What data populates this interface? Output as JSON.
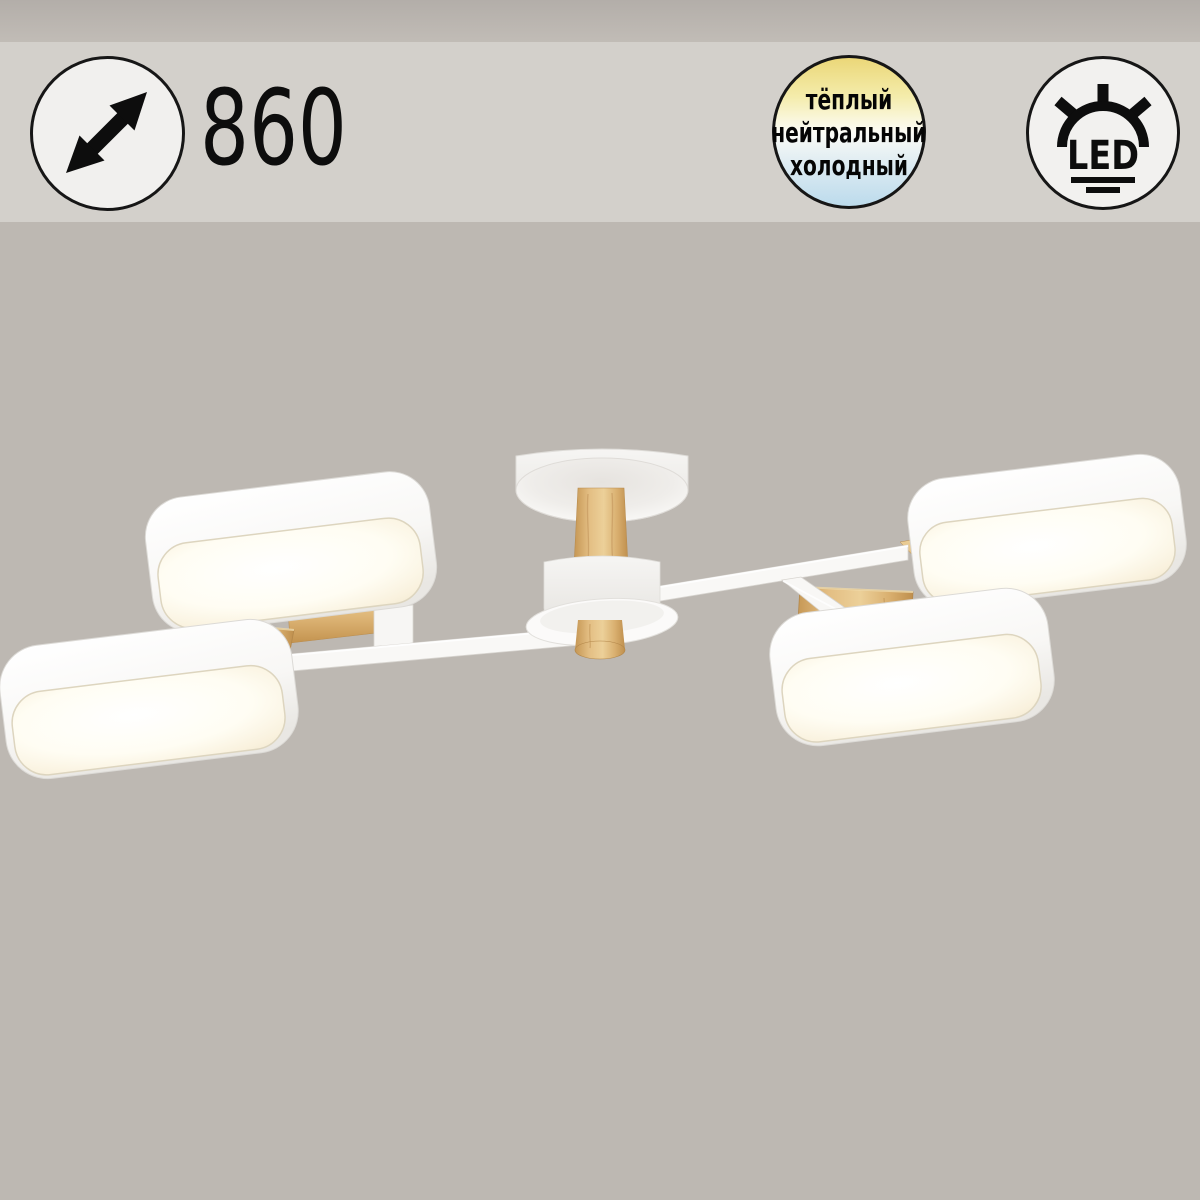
{
  "page": {
    "background_color": "#bdb8b2",
    "header_band_color": "#d3d0cb"
  },
  "badges": {
    "diameter": {
      "value": "860",
      "icon": "diagonal-double-arrow",
      "circle_fill": "#f1f0ee",
      "circle_stroke": "#161616"
    },
    "color_temperature": {
      "circle_stroke": "#161616",
      "options": [
        {
          "label": "тёплый",
          "swatch": "#ebd778"
        },
        {
          "label": "нейтральный",
          "swatch": "#fcfcf6"
        },
        {
          "label": "холодный",
          "swatch": "#bcdbec"
        }
      ]
    },
    "led": {
      "label": "LED",
      "icon": "led-light-rays",
      "circle_fill": "#f2f1ef",
      "circle_stroke": "#161616"
    }
  },
  "product": {
    "description": "four-light ceiling chandelier with rounded-square LED shades, white metal arms and wood accents",
    "shade_count": 4,
    "colors": {
      "shade_body": "#fafaf8",
      "shade_glow_center": "#ffffff",
      "shade_glow_edge": "#f2e8cf",
      "wood": "#ddb678",
      "arm": "#f9f8f6"
    }
  }
}
